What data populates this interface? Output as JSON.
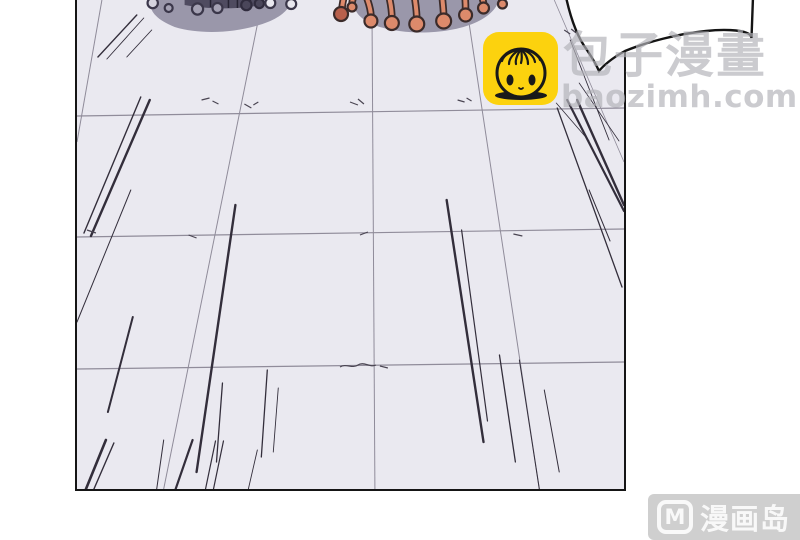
{
  "page": {
    "width": 800,
    "height": 540,
    "background_color": "#ffffff",
    "description": "manga panel: perspective tiled floor with speed lines, two creatures cut off at top, speech bubble tail at top right"
  },
  "panel": {
    "floor_color": "#eae9f0",
    "border_color": "#151515",
    "grid_line_color": "#908c9a",
    "speed_line_color": "#332e3b"
  },
  "creatures": {
    "left": "gray blob creature with ring suction cups",
    "right": "gray blob creature with coral tentacle knobs",
    "body_color": "#9a97aa",
    "ring_outline_color": "#3b374a",
    "knob_color": "#dd8a6b",
    "knob_dark_color": "#b8604c",
    "knob_outline_color": "#3b2b2a"
  },
  "speech_bubble": {
    "fill": "#ffffff",
    "stroke": "#141414"
  },
  "watermark_baozi": {
    "icon": "baozi-bun-icon",
    "icon_bg": "#fcd20e",
    "icon_line_color": "#191919",
    "title": "包子漫畫",
    "url": "baozimh.com",
    "text_color": "rgba(178,178,184,0.68)"
  },
  "watermark_manhuadao": {
    "badge_letter": "M",
    "site_name": "漫画岛",
    "bg_color": "rgba(167,167,167,0.55)",
    "text_color": "rgba(255,255,255,0.85)"
  }
}
